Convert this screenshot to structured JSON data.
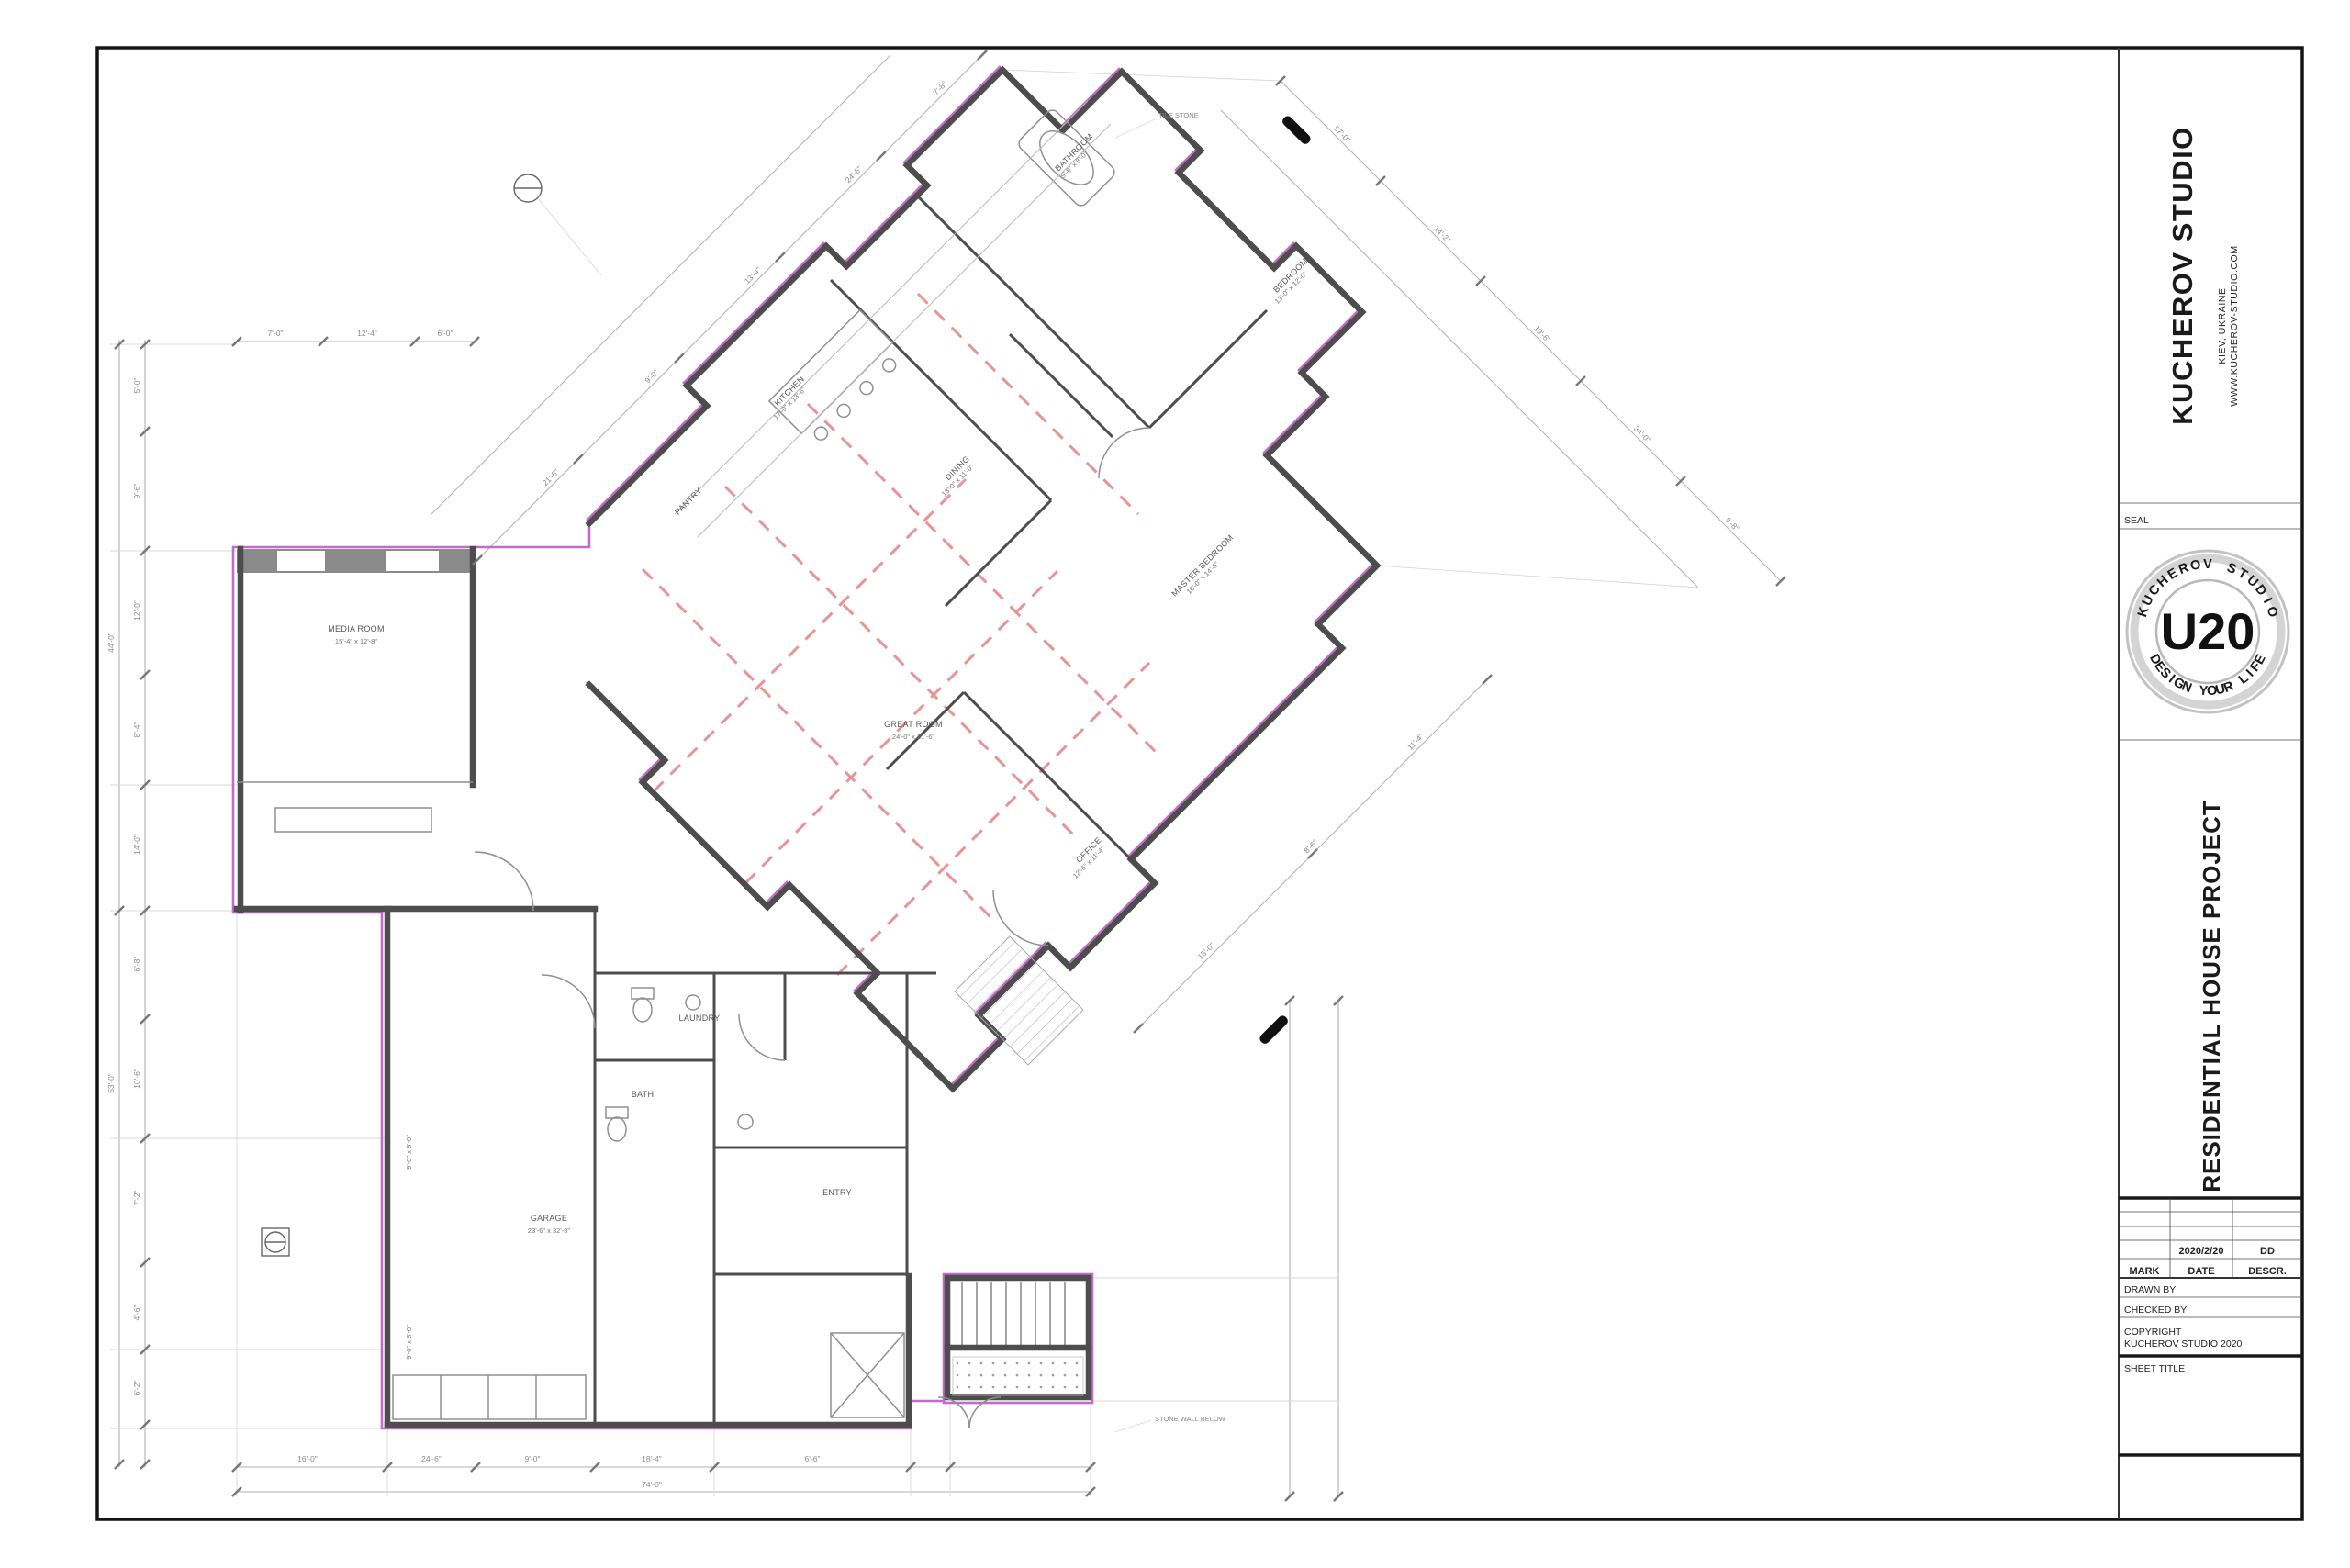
{
  "title_block": {
    "studio_name": "KUCHEROV STUDIO",
    "studio_location": "KIEV, UKRAINE",
    "studio_website": "WWW.KUCHEROV-STUDIO.COM",
    "seal_label": "SEAL",
    "seal": {
      "top_text": "KUCHEROV STUDIO",
      "center_text": "U20",
      "bottom_text": "DESIGN YOUR LIFE"
    },
    "project_title": "RESIDENTIAL HOUSE PROJECT",
    "revision": {
      "headers": [
        "MARK",
        "DATE",
        "DESCR."
      ],
      "row_date": "2020/2/20",
      "row_descr": "DD"
    },
    "drawn_by_label": "DRAWN BY",
    "checked_by_label": "CHECKED BY",
    "copyright_line1": "COPYRIGHT",
    "copyright_line2": "KUCHEROV STUDIO 2020",
    "sheet_title_label": "SHEET TITLE"
  },
  "plan": {
    "colors": {
      "highlight": "#c46bc9",
      "wall": "#4d4d4d",
      "wall_fill": "#8a8a8a",
      "dim": "#b2b2b2",
      "beam": "#e89494",
      "fixture": "#8f8f8f"
    },
    "room_labels": [
      {
        "name": "MEDIA ROOM",
        "size": "15'-4\" x 12'-8\""
      },
      {
        "name": "GARAGE",
        "size": "23'-6\" x 32'-8\""
      },
      {
        "name": "GREAT ROOM",
        "size": "24'-0\" x 21'-6\""
      },
      {
        "name": "KITCHEN",
        "size": "17'-0\" x 13'-6\""
      },
      {
        "name": "DINING",
        "size": "13'-0\" x 11'-0\""
      },
      {
        "name": "MASTER BEDROOM",
        "size": "16'-0\" x 14'-6\""
      },
      {
        "name": "BEDROOM",
        "size": "13'-0\" x 12'-0\""
      },
      {
        "name": "BATHROOM",
        "size": "9'-6\" x 8'-0\""
      },
      {
        "name": "OFFICE",
        "size": "12'-6\" x 11'-4\""
      },
      {
        "name": "ENTRY",
        "size": ""
      },
      {
        "name": "LAUNDRY",
        "size": ""
      },
      {
        "name": "BATH",
        "size": ""
      },
      {
        "name": "PANTRY",
        "size": ""
      }
    ],
    "garage_door_labels": [
      "9'-0\" x 8'-0\"",
      "9'-0\" x 8'-0\""
    ],
    "annotations": [
      "TILE STONE",
      "STONE WALL BELOW"
    ],
    "dimensions": {
      "left": [
        "5'-0\"",
        "9'-6\"",
        "12'-0\"",
        "8'-4\"",
        "14'-0\"",
        "6'-8\"",
        "10'-6\"",
        "7'-2\"",
        "4'-6\"",
        "6'-2\""
      ],
      "left_overall": [
        "44'-0\"",
        "53'-0\""
      ],
      "bottom": [
        "16'-0\"",
        "24'-6\"",
        "9'-0\"",
        "18'-4\"",
        "6'-6\""
      ],
      "bottom_overall": "74'-0\"",
      "top": [
        "7'-0\"",
        "12'-4\"",
        "6'-0\""
      ],
      "nw": [
        "21'-6\"",
        "9'-0\"",
        "13'-4\"",
        "24'-6\"",
        "7'-8\""
      ],
      "ne": [
        "57'-0\"",
        "14'-2\"",
        "19'-6\"",
        "34'-0\"",
        "9'-8\""
      ],
      "se": [
        "11'-4\"",
        "8'-6\"",
        "15'-0\""
      ]
    }
  }
}
